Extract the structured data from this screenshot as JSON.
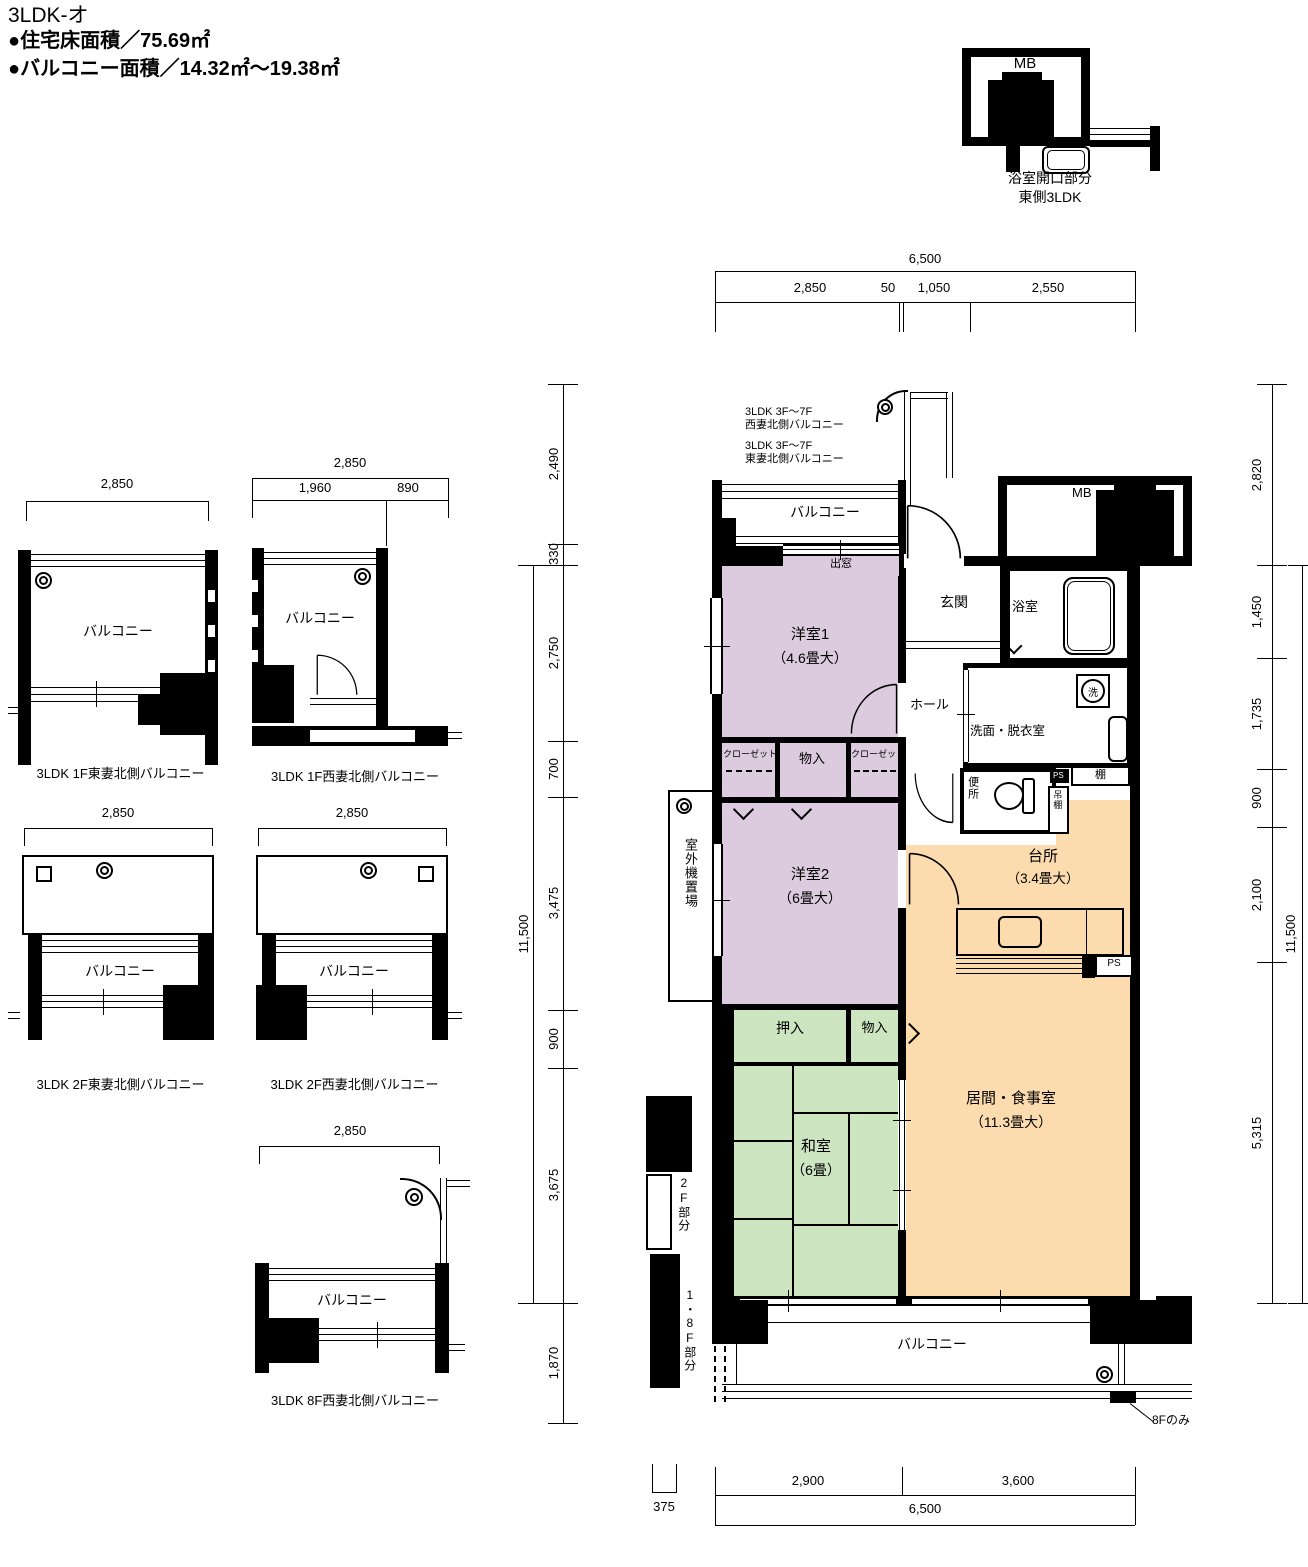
{
  "header": {
    "title": "3LDK-オ",
    "area_line1": "●住宅床面積／75.69㎡",
    "area_line2": "●バルコニー面積／14.32㎡～19.38㎡"
  },
  "inset": {
    "mb": "MB",
    "caption_line1": "浴室開口部分",
    "caption_line2": "東側3LDK"
  },
  "dims": {
    "top_total": "6,500",
    "top_seg1": "2,850",
    "top_seg2": "50",
    "top_seg3": "1,050",
    "top_seg4": "2,550",
    "bottom_seg1": "2,900",
    "bottom_seg2": "3,600",
    "bottom_total": "6,500",
    "bottom_small": "375",
    "left_seg1": "2,490",
    "left_seg2": "330",
    "left_seg3": "2,750",
    "left_seg4": "700",
    "left_seg5": "3,475",
    "left_seg6": "900",
    "left_seg7": "3,675",
    "left_seg8": "1,870",
    "left_total": "11,500",
    "right_seg0": "2,820",
    "right_seg1": "1,450",
    "right_seg2": "1,735",
    "right_seg3": "900",
    "right_seg4": "2,100",
    "right_seg5": "5,315",
    "right_total": "11,500"
  },
  "plan": {
    "balcony_north": "バルコニー",
    "demado": "出窓",
    "note1_line1": "3LDK 3F～7F",
    "note1_line2": "西妻北側バルコニー",
    "note2_line1": "3LDK 3F～7F",
    "note2_line2": "東妻北側バルコニー",
    "mb": "MB",
    "genkan": "玄関",
    "bath": "浴室",
    "hall": "ホール",
    "washroom": "洗面・脱衣室",
    "washer": "洗",
    "toilet": "便所",
    "ps_top": "PS",
    "tsuridana": "吊棚",
    "tana": "棚",
    "yoshitsu1": "洋室1",
    "yoshitsu1_size": "（4.6畳大）",
    "closet_left": "クローゼット",
    "monoire_top": "物入",
    "closet_right": "クローゼット",
    "yoshitsu2": "洋室2",
    "yoshitsu2_size": "（6畳大）",
    "outdoor_unit": "室外機置場",
    "kitchen": "台所",
    "kitchen_size": "（3.4畳大）",
    "ps_kitchen": "PS",
    "oshiire": "押入",
    "monoire_bottom": "物入",
    "washitsu": "和室",
    "washitsu_size": "（6畳）",
    "living": "居間・食事室",
    "living_size": "（11.3畳大）",
    "balcony_south": "バルコニー",
    "floor2_label": "2F部分",
    "floor18_label": "1・8F部分",
    "only8f": "8Fのみ"
  },
  "diagrams": [
    {
      "dim": "2,850",
      "label": "バルコニー",
      "caption": "3LDK 1F東妻北側バルコニー"
    },
    {
      "dim": "2,850",
      "sub_left": "1,960",
      "sub_right": "890",
      "label": "バルコニー",
      "caption": "3LDK 1F西妻北側バルコニー"
    },
    {
      "dim": "2,850",
      "label": "バルコニー",
      "caption": "3LDK 2F東妻北側バルコニー"
    },
    {
      "dim": "2,850",
      "label": "バルコニー",
      "caption": "3LDK 2F西妻北側バルコニー"
    },
    {
      "dim": "2,850",
      "label": "バルコニー",
      "caption": "3LDK 8F西妻北側バルコニー"
    }
  ],
  "colors": {
    "western_room": "#dccade",
    "tatami_room": "#cde5c0",
    "ldk": "#fcdcae",
    "wall": "#000000"
  }
}
